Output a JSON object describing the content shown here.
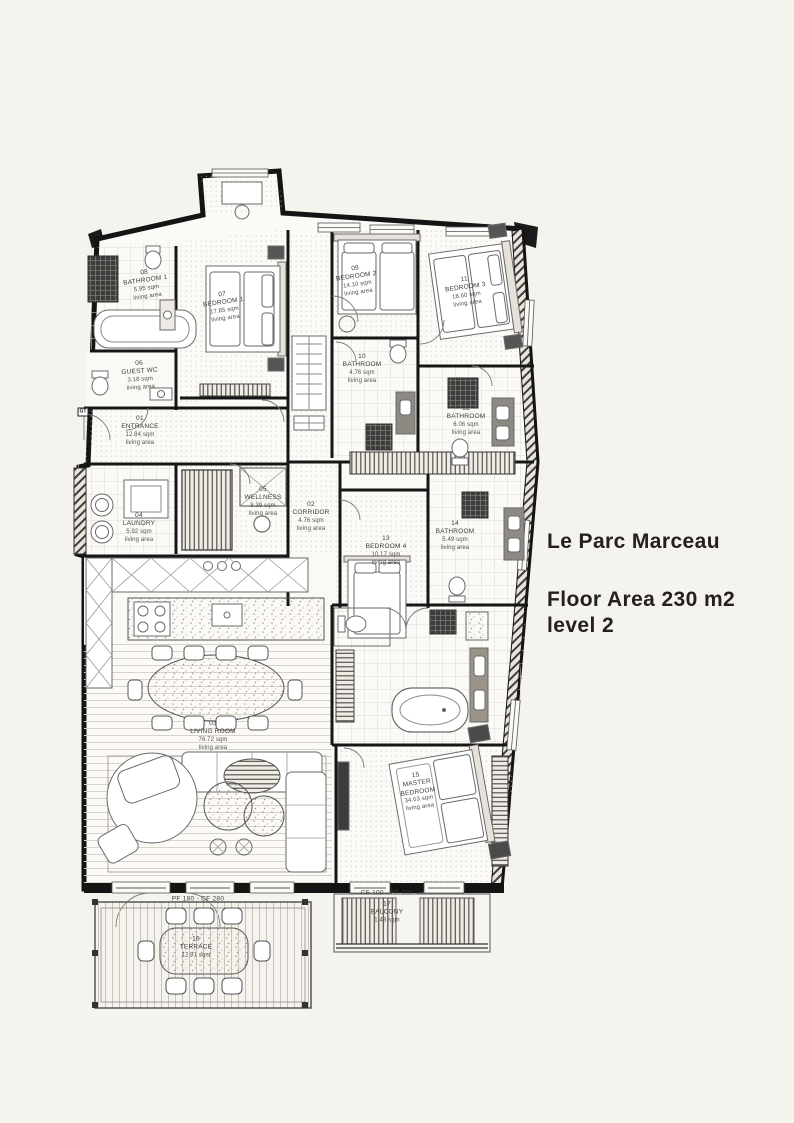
{
  "title": {
    "name": "Le Parc Marceau",
    "floor_area": "Floor Area 230 m2",
    "level": "level 2"
  },
  "colors": {
    "background": "#f5f3ee",
    "ink": "#141414",
    "floor": "#fbfaf7"
  },
  "plan": {
    "annotations": {
      "terrace_spec": "PF 180 - CF 280",
      "balcony_spec": "CF 100 - PF 100",
      "panel_tag": "GT"
    },
    "rooms": [
      {
        "number": "01",
        "name": "ENTRANCE",
        "area": "12.84 sqm",
        "note": "living area"
      },
      {
        "number": "02",
        "name": "CORRIDOR",
        "area": "4.76 sqm",
        "note": "living area"
      },
      {
        "number": "03",
        "name": "LIVING ROOM",
        "area": "76.72 sqm",
        "note": "living area"
      },
      {
        "number": "04",
        "name": "LAUNDRY",
        "area": "5.92 sqm",
        "note": "living area"
      },
      {
        "number": "05",
        "name": "WELLNESS",
        "area": "8.39 sqm",
        "note": "living area"
      },
      {
        "number": "06",
        "name": "GUEST WC",
        "area": "3.18 sqm",
        "note": "living area"
      },
      {
        "number": "07",
        "name": "BEDROOM 1",
        "area": "17.85 sqm",
        "note": "living area"
      },
      {
        "number": "08",
        "name": "BATHROOM 1",
        "area": "5.95 sqm",
        "note": "living area"
      },
      {
        "number": "09",
        "name": "BEDROOM 2",
        "area": "14.10 sqm",
        "note": "living area"
      },
      {
        "number": "10",
        "name": "BATHROOM",
        "area": "4.76 sqm",
        "note": "living area"
      },
      {
        "number": "11",
        "name": "BEDROOM 3",
        "area": "18.60 sqm",
        "note": "living area"
      },
      {
        "number": "12",
        "name": "BATHROOM",
        "area": "6.06 sqm",
        "note": "living area"
      },
      {
        "number": "13",
        "name": "BEDROOM 4",
        "area": "10.17 sqm",
        "note": "living area"
      },
      {
        "number": "14",
        "name": "BATHROOM",
        "area": "5.49 sqm",
        "note": "living area"
      },
      {
        "number": "15",
        "name": "MASTER BEDROOM",
        "area": "34.63 sqm",
        "note": "living area"
      },
      {
        "number": "16",
        "name": "TERRACE",
        "area": "12.91 sqm",
        "note": ""
      },
      {
        "number": "17",
        "name": "BALCONY",
        "area": "1.48 sqm",
        "note": ""
      }
    ]
  }
}
